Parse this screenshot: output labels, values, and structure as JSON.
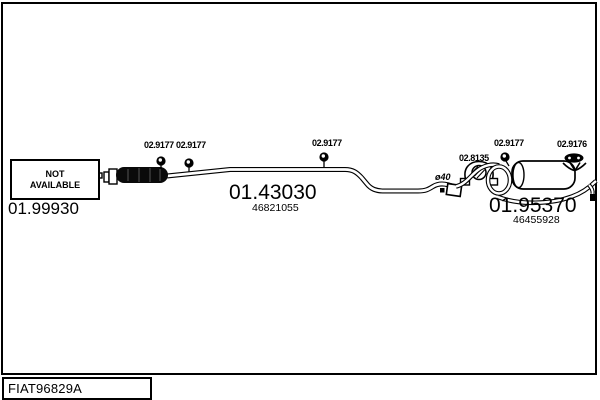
{
  "diagram": {
    "code": "FIAT96829A",
    "not_available_box": {
      "line1": "NOT",
      "line2": "AVAILABLE"
    },
    "front_section": {
      "part_number": "01.99930"
    },
    "center_section": {
      "part_number": "01.43030",
      "oem_number": "46821055"
    },
    "rear_section": {
      "part_number": "01.95370",
      "oem_number": "46455928"
    },
    "hanger_labels": [
      {
        "part_number": "02.9177"
      },
      {
        "part_number": "02.9177"
      },
      {
        "part_number": "02.9177"
      },
      {
        "part_number": "02.9177"
      },
      {
        "part_number": "02.9176"
      },
      {
        "part_number": "02.8135"
      }
    ],
    "pipe_diameter_label": "ø40",
    "colors": {
      "line": "#000000",
      "background": "#ffffff"
    }
  }
}
